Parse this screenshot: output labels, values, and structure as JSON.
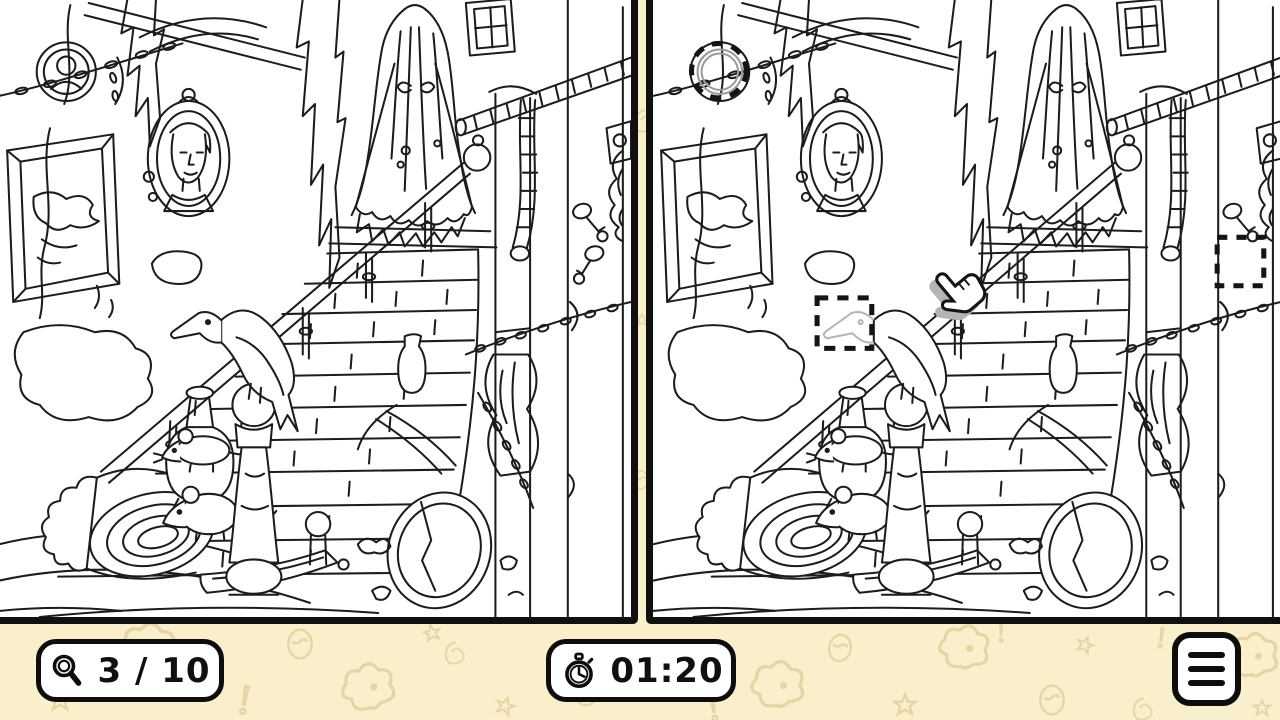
{
  "app": {
    "type": "spot-the-difference-game",
    "scene": "haunted mansion staircase with ghost bride, raven, portraits, mice and rolled rug"
  },
  "hud": {
    "found": {
      "icon": "magnifier-icon",
      "current": 3,
      "total": 10,
      "label": "3 / 10"
    },
    "timer": {
      "icon": "stopwatch-icon",
      "value": "01:20"
    },
    "menu": {
      "icon": "hamburger-menu-icon"
    }
  },
  "panels": {
    "left": {
      "name": "original-image"
    },
    "right": {
      "name": "modified-image",
      "found_markers": [
        {
          "shape": "dashed-circle",
          "location": "round portrait, top left",
          "difference": "portrait face missing"
        },
        {
          "shape": "dashed-square",
          "location": "raven head, mid left",
          "difference": "raven head erased"
        },
        {
          "shape": "dashed-square",
          "location": "right column",
          "difference": "second door key missing"
        }
      ],
      "cursor": "hand-pointer over staircase"
    }
  },
  "colors": {
    "background": "#FAEFCB",
    "pattern": "#DFCB96",
    "panel_bg": "#FFFFFF",
    "line_art": "#1C1C1C",
    "border": "#101010",
    "marker": "#141414",
    "faded_difference": "#B5B5B5"
  }
}
